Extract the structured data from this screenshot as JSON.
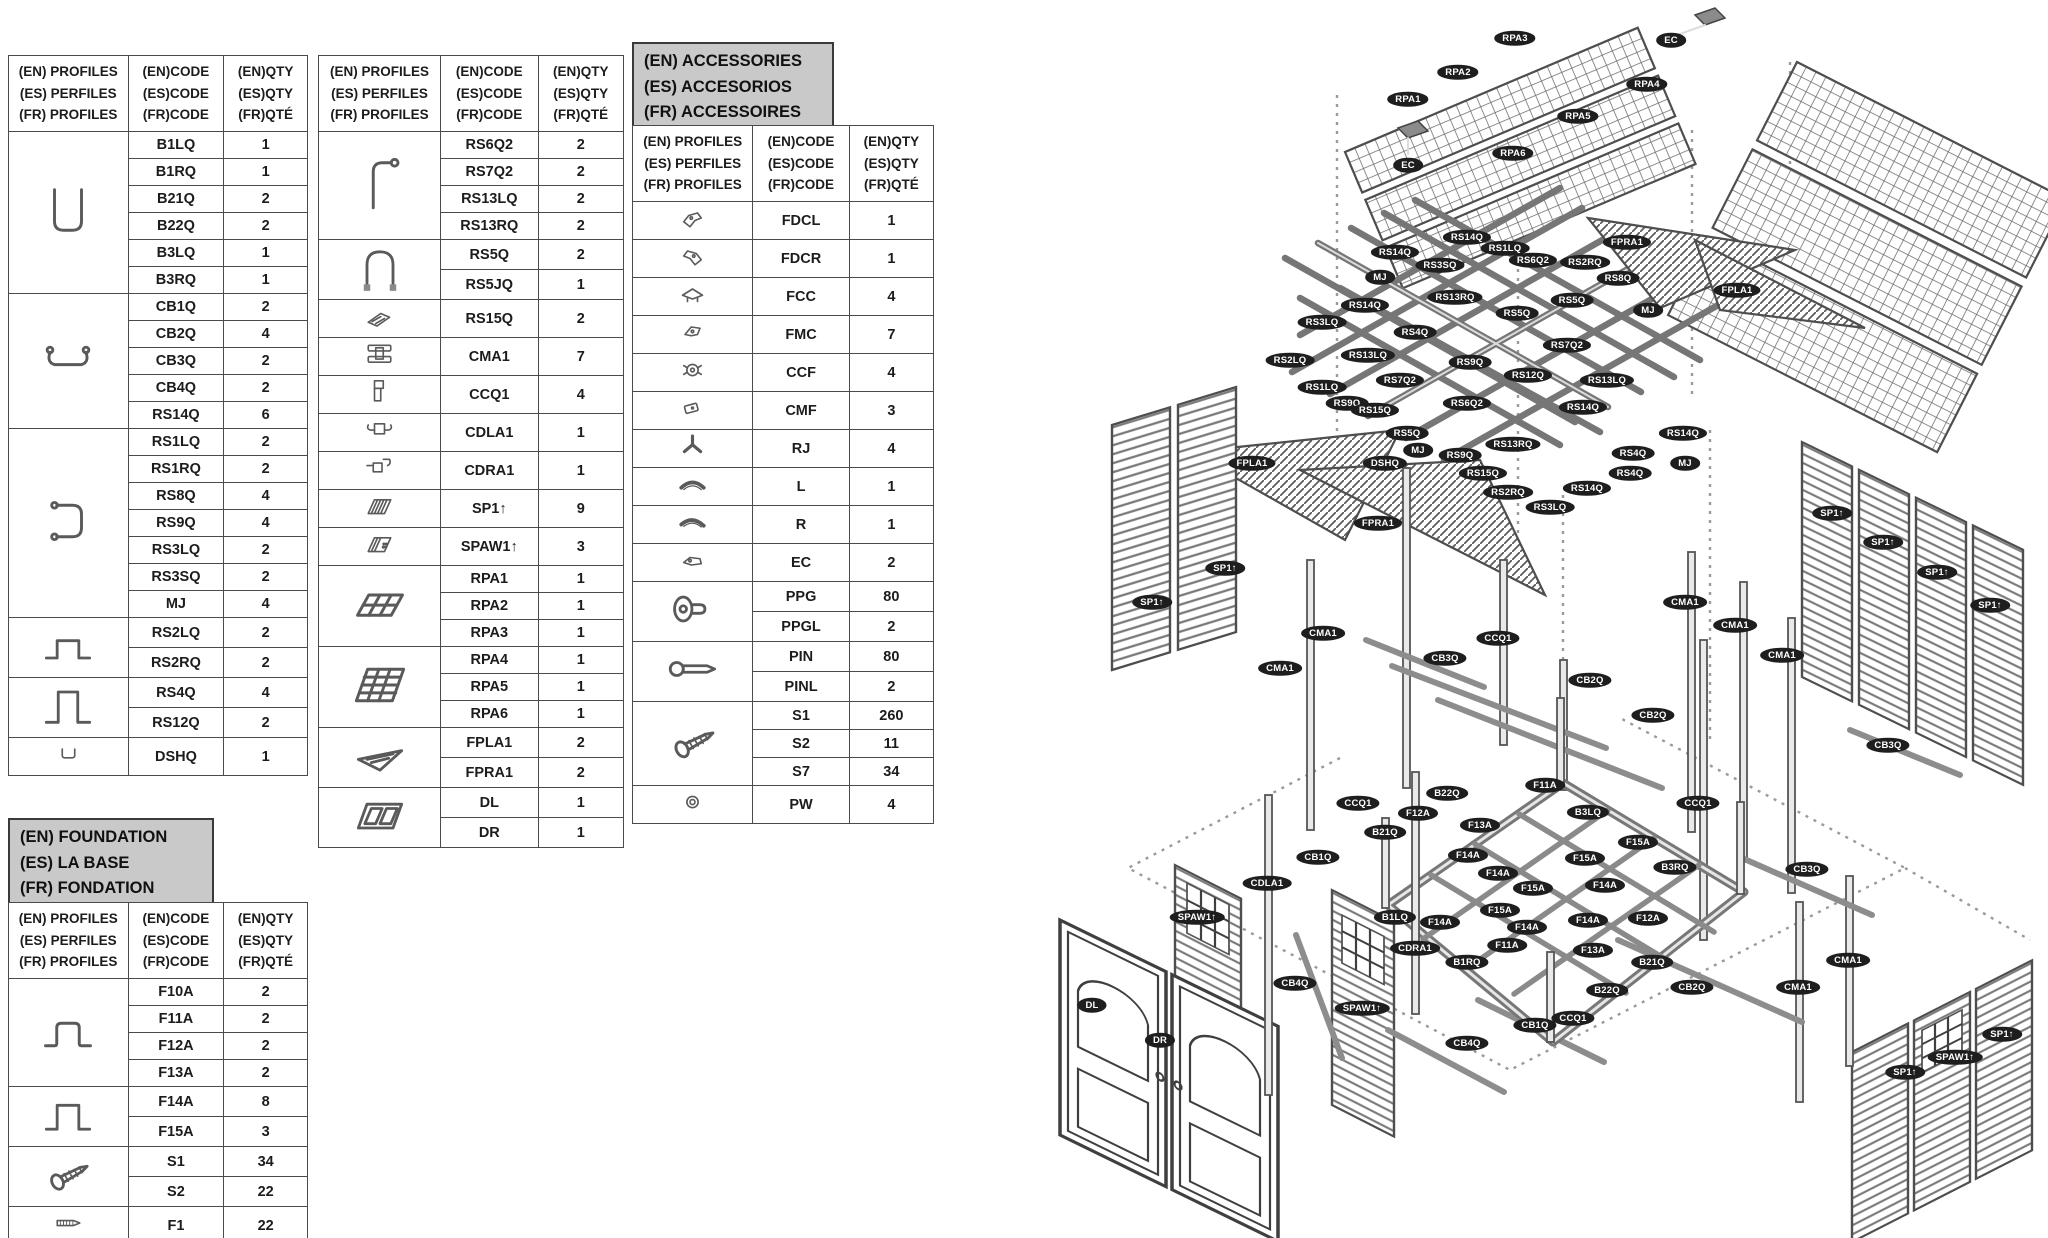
{
  "colors": {
    "label_bg": "#1e1e1e",
    "title_box_bg": "#c9c9c9",
    "beam": "#767676"
  },
  "tables": {
    "profiles_left": {
      "header": {
        "profiles": "(EN) PROFILES\n(ES) PERFILES\n(FR) PROFILES",
        "code": "(EN)CODE\n(ES)CODE\n(FR)CODE",
        "qty": "(EN)QTY\n(ES)QTY\n(FR)QTÉ"
      },
      "groups": [
        {
          "icon": "u-channel",
          "rows": [
            [
              "B1LQ",
              "1"
            ],
            [
              "B1RQ",
              "1"
            ],
            [
              "B21Q",
              "2"
            ],
            [
              "B22Q",
              "2"
            ],
            [
              "B3LQ",
              "1"
            ],
            [
              "B3RQ",
              "1"
            ]
          ]
        },
        {
          "icon": "c-channel",
          "rows": [
            [
              "CB1Q",
              "2"
            ],
            [
              "CB2Q",
              "4"
            ],
            [
              "CB3Q",
              "2"
            ],
            [
              "CB4Q",
              "2"
            ],
            [
              "RS14Q",
              "6"
            ]
          ]
        },
        {
          "icon": "bracket-rs1",
          "rows": [
            [
              "RS1LQ",
              "2"
            ],
            [
              "RS1RQ",
              "2"
            ],
            [
              "RS8Q",
              "4"
            ],
            [
              "RS9Q",
              "4"
            ],
            [
              "RS3LQ",
              "2"
            ],
            [
              "RS3SQ",
              "2"
            ],
            [
              "MJ",
              "4"
            ]
          ]
        },
        {
          "icon": "hat-low",
          "rows": [
            [
              "RS2LQ",
              "2"
            ],
            [
              "RS2RQ",
              "2"
            ]
          ]
        },
        {
          "icon": "hat-tall",
          "rows": [
            [
              "RS4Q",
              "4"
            ],
            [
              "RS12Q",
              "2"
            ]
          ]
        },
        {
          "icon": "mini-channel",
          "rows": [
            [
              "DSHQ",
              "1"
            ]
          ]
        }
      ]
    },
    "profiles_mid": {
      "header": {
        "profiles": "(EN) PROFILES\n(ES) PERFILES\n(FR) PROFILES",
        "code": "(EN)CODE\n(ES)CODE\n(FR)CODE",
        "qty": "(EN)QTY\n(ES)QTY\n(FR)QTÉ"
      },
      "groups": [
        {
          "icon": "corner-pole",
          "rows": [
            [
              "RS6Q2",
              "2"
            ],
            [
              "RS7Q2",
              "2"
            ],
            [
              "RS13LQ",
              "2"
            ],
            [
              "RS13RQ",
              "2"
            ]
          ]
        },
        {
          "icon": "arch",
          "rows": [
            [
              "RS5Q",
              "2"
            ],
            [
              "RS5JQ",
              "1"
            ]
          ]
        },
        {
          "icon": "plate-rs15",
          "rows": [
            [
              "RS15Q",
              "2"
            ]
          ]
        },
        {
          "icon": "conn-cma",
          "rows": [
            [
              "CMA1",
              "7"
            ]
          ]
        },
        {
          "icon": "conn-ccq",
          "rows": [
            [
              "CCQ1",
              "4"
            ]
          ]
        },
        {
          "icon": "conn-cdla",
          "rows": [
            [
              "CDLA1",
              "1"
            ]
          ]
        },
        {
          "icon": "conn-cdra",
          "rows": [
            [
              "CDRA1",
              "1"
            ]
          ]
        },
        {
          "icon": "panel-hatch",
          "rows": [
            [
              "SP1↑",
              "9"
            ]
          ]
        },
        {
          "icon": "panel-hatch-dots",
          "rows": [
            [
              "SPAW1↑",
              "3"
            ]
          ]
        },
        {
          "icon": "panel-grid",
          "rows": [
            [
              "RPA1",
              "1"
            ],
            [
              "RPA2",
              "1"
            ],
            [
              "RPA3",
              "1"
            ]
          ]
        },
        {
          "icon": "panel-grid-lg",
          "rows": [
            [
              "RPA4",
              "1"
            ],
            [
              "RPA5",
              "1"
            ],
            [
              "RPA6",
              "1"
            ]
          ]
        },
        {
          "icon": "gable",
          "rows": [
            [
              "FPLA1",
              "2"
            ],
            [
              "FPRA1",
              "2"
            ]
          ]
        },
        {
          "icon": "doors-icon",
          "rows": [
            [
              "DL",
              "1"
            ],
            [
              "DR",
              "1"
            ]
          ]
        }
      ]
    },
    "accessories": {
      "title": "(EN) ACCESSORIES\n(ES) ACCESORIOS\n(FR) ACCESSOIRES",
      "header": {
        "profiles": "(EN) PROFILES\n(ES) PERFILES\n(FR) PROFILES",
        "code": "(EN)CODE\n(ES)CODE\n(FR)CODE",
        "qty": "(EN)QTY\n(ES)QTY\n(FR)QTÉ"
      },
      "groups": [
        {
          "icon": "fdcl",
          "rows": [
            [
              "FDCL",
              "1"
            ]
          ]
        },
        {
          "icon": "fdcr",
          "rows": [
            [
              "FDCR",
              "1"
            ]
          ]
        },
        {
          "icon": "fcc",
          "rows": [
            [
              "FCC",
              "4"
            ]
          ]
        },
        {
          "icon": "fmc",
          "rows": [
            [
              "FMC",
              "7"
            ]
          ]
        },
        {
          "icon": "ccf",
          "rows": [
            [
              "CCF",
              "4"
            ]
          ]
        },
        {
          "icon": "cmf",
          "rows": [
            [
              "CMF",
              "3"
            ]
          ]
        },
        {
          "icon": "rj",
          "rows": [
            [
              "RJ",
              "4"
            ]
          ]
        },
        {
          "icon": "arc-l",
          "rows": [
            [
              "L",
              "1"
            ]
          ]
        },
        {
          "icon": "arc-r",
          "rows": [
            [
              "R",
              "1"
            ]
          ]
        },
        {
          "icon": "ec",
          "rows": [
            [
              "EC",
              "2"
            ]
          ]
        },
        {
          "icon": "ppg",
          "rows": [
            [
              "PPG",
              "80"
            ],
            [
              "PPGL",
              "2"
            ]
          ]
        },
        {
          "icon": "pin",
          "rows": [
            [
              "PIN",
              "80"
            ],
            [
              "PINL",
              "2"
            ]
          ]
        },
        {
          "icon": "screw",
          "rows": [
            [
              "S1",
              "260"
            ],
            [
              "S2",
              "11"
            ],
            [
              "S7",
              "34"
            ]
          ]
        },
        {
          "icon": "washer",
          "rows": [
            [
              "PW",
              "4"
            ]
          ]
        }
      ]
    },
    "foundation": {
      "title": "(EN) FOUNDATION\n(ES) LA BASE\n(FR) FONDATION",
      "header": {
        "profiles": "(EN) PROFILES\n(ES) PERFILES\n(FR) PROFILES",
        "code": "(EN)CODE\n(ES)CODE\n(FR)CODE",
        "qty": "(EN)QTY\n(ES)QTY\n(FR)QTÉ"
      },
      "groups": [
        {
          "icon": "hat-f10",
          "rows": [
            [
              "F10A",
              "2"
            ],
            [
              "F11A",
              "2"
            ],
            [
              "F12A",
              "2"
            ],
            [
              "F13A",
              "2"
            ]
          ]
        },
        {
          "icon": "hat-f14",
          "rows": [
            [
              "F14A",
              "8"
            ],
            [
              "F15A",
              "3"
            ]
          ]
        },
        {
          "icon": "screw",
          "rows": [
            [
              "S1",
              "34"
            ],
            [
              "S2",
              "22"
            ]
          ]
        },
        {
          "icon": "anchor-f1",
          "rows": [
            [
              "F1",
              "22"
            ]
          ]
        }
      ]
    }
  },
  "diagram": {
    "labels": [
      [
        "EC",
        1671,
        40
      ],
      [
        "RPA3",
        1515,
        38
      ],
      [
        "RPA2",
        1458,
        72
      ],
      [
        "RPA1",
        1408,
        99
      ],
      [
        "RPA4",
        1647,
        84
      ],
      [
        "RPA5",
        1578,
        116
      ],
      [
        "RPA6",
        1513,
        153
      ],
      [
        "EC",
        1408,
        165
      ],
      [
        "FPRA1",
        1627,
        242
      ],
      [
        "FPLA1",
        1737,
        290
      ],
      [
        "MJ",
        1380,
        277
      ],
      [
        "RS14Q",
        1395,
        252
      ],
      [
        "RS14Q",
        1467,
        237
      ],
      [
        "RS3SQ",
        1440,
        265
      ],
      [
        "RS1LQ",
        1505,
        248
      ],
      [
        "RS6Q2",
        1533,
        260
      ],
      [
        "RS2RQ",
        1585,
        262
      ],
      [
        "RS8Q",
        1618,
        278
      ],
      [
        "RS14Q",
        1365,
        305
      ],
      [
        "RS13RQ",
        1455,
        297
      ],
      [
        "RS5Q",
        1572,
        300
      ],
      [
        "RS3LQ",
        1322,
        322
      ],
      [
        "RS4Q",
        1415,
        332
      ],
      [
        "RS5Q",
        1517,
        313
      ],
      [
        "MJ",
        1648,
        310
      ],
      [
        "RS2LQ",
        1290,
        360
      ],
      [
        "RS13LQ",
        1368,
        355
      ],
      [
        "RS7Q2",
        1400,
        380
      ],
      [
        "RS9Q",
        1470,
        362
      ],
      [
        "RS7Q2",
        1567,
        345
      ],
      [
        "RS12Q",
        1528,
        375
      ],
      [
        "RS1LQ",
        1322,
        387
      ],
      [
        "RS13LQ",
        1607,
        380
      ],
      [
        "RS9Q",
        1347,
        403
      ],
      [
        "RS15Q",
        1375,
        410
      ],
      [
        "RS6Q2",
        1467,
        403
      ],
      [
        "RS14Q",
        1583,
        407
      ],
      [
        "RS5Q",
        1407,
        433
      ],
      [
        "RS14Q",
        1683,
        433
      ],
      [
        "MJ",
        1418,
        450
      ],
      [
        "RS13RQ",
        1513,
        444
      ],
      [
        "RS4Q",
        1633,
        453
      ],
      [
        "RS9Q",
        1460,
        455
      ],
      [
        "DSHQ",
        1385,
        463
      ],
      [
        "MJ",
        1685,
        463
      ],
      [
        "RS15Q",
        1483,
        473
      ],
      [
        "RS4Q",
        1630,
        473
      ],
      [
        "RS2RQ",
        1508,
        492
      ],
      [
        "RS14Q",
        1587,
        488
      ],
      [
        "RS3LQ",
        1550,
        507
      ],
      [
        "FPLA1",
        1252,
        463
      ],
      [
        "FPRA1",
        1378,
        523
      ],
      [
        "SP1↑",
        1152,
        602
      ],
      [
        "SP1↑",
        1225,
        568
      ],
      [
        "SP1↑",
        1832,
        513
      ],
      [
        "SP1↑",
        1883,
        542
      ],
      [
        "SP1↑",
        1937,
        572
      ],
      [
        "SP1↑",
        1990,
        605
      ],
      [
        "CMA1",
        1323,
        633
      ],
      [
        "CMA1",
        1280,
        668
      ],
      [
        "CB3Q",
        1445,
        658
      ],
      [
        "CCQ1",
        1498,
        638
      ],
      [
        "CB2Q",
        1590,
        680
      ],
      [
        "CB2Q",
        1653,
        715
      ],
      [
        "CMA1",
        1685,
        602
      ],
      [
        "CMA1",
        1735,
        625
      ],
      [
        "CMA1",
        1782,
        655
      ],
      [
        "CB3Q",
        1888,
        745
      ],
      [
        "CCQ1",
        1358,
        803
      ],
      [
        "B22Q",
        1447,
        793
      ],
      [
        "F12A",
        1418,
        813
      ],
      [
        "F13A",
        1480,
        825
      ],
      [
        "F11A",
        1545,
        785
      ],
      [
        "B3LQ",
        1588,
        812
      ],
      [
        "B21Q",
        1385,
        832
      ],
      [
        "F14A",
        1468,
        855
      ],
      [
        "F15A",
        1638,
        842
      ],
      [
        "CCQ1",
        1698,
        803
      ],
      [
        "F14A",
        1498,
        873
      ],
      [
        "F15A",
        1585,
        858
      ],
      [
        "B3RQ",
        1675,
        867
      ],
      [
        "F15A",
        1533,
        888
      ],
      [
        "F14A",
        1605,
        885
      ],
      [
        "B1LQ",
        1395,
        917
      ],
      [
        "F15A",
        1500,
        910
      ],
      [
        "F14A",
        1588,
        920
      ],
      [
        "F12A",
        1648,
        918
      ],
      [
        "CDRA1",
        1415,
        948
      ],
      [
        "F14A",
        1440,
        922
      ],
      [
        "F14A",
        1527,
        927
      ],
      [
        "F11A",
        1507,
        945
      ],
      [
        "F13A",
        1593,
        950
      ],
      [
        "B21Q",
        1652,
        962
      ],
      [
        "B1RQ",
        1467,
        962
      ],
      [
        "B22Q",
        1607,
        990
      ],
      [
        "CB2Q",
        1692,
        987
      ],
      [
        "CB1Q",
        1535,
        1025
      ],
      [
        "CCQ1",
        1573,
        1018
      ],
      [
        "CB4Q",
        1467,
        1043
      ],
      [
        "CB1Q",
        1318,
        857
      ],
      [
        "CDLA1",
        1267,
        883
      ],
      [
        "CB4Q",
        1295,
        983
      ],
      [
        "SPAW1↑",
        1197,
        917
      ],
      [
        "DL",
        1092,
        1005
      ],
      [
        "DR",
        1160,
        1040
      ],
      [
        "SPAW1↑",
        1362,
        1008
      ],
      [
        "CB3Q",
        1807,
        869
      ],
      [
        "CMA1",
        1848,
        960
      ],
      [
        "CMA1",
        1798,
        987
      ],
      [
        "SP1↑",
        1905,
        1072
      ],
      [
        "SPAW1↑",
        1955,
        1057
      ],
      [
        "SP1↑",
        2002,
        1034
      ]
    ]
  }
}
